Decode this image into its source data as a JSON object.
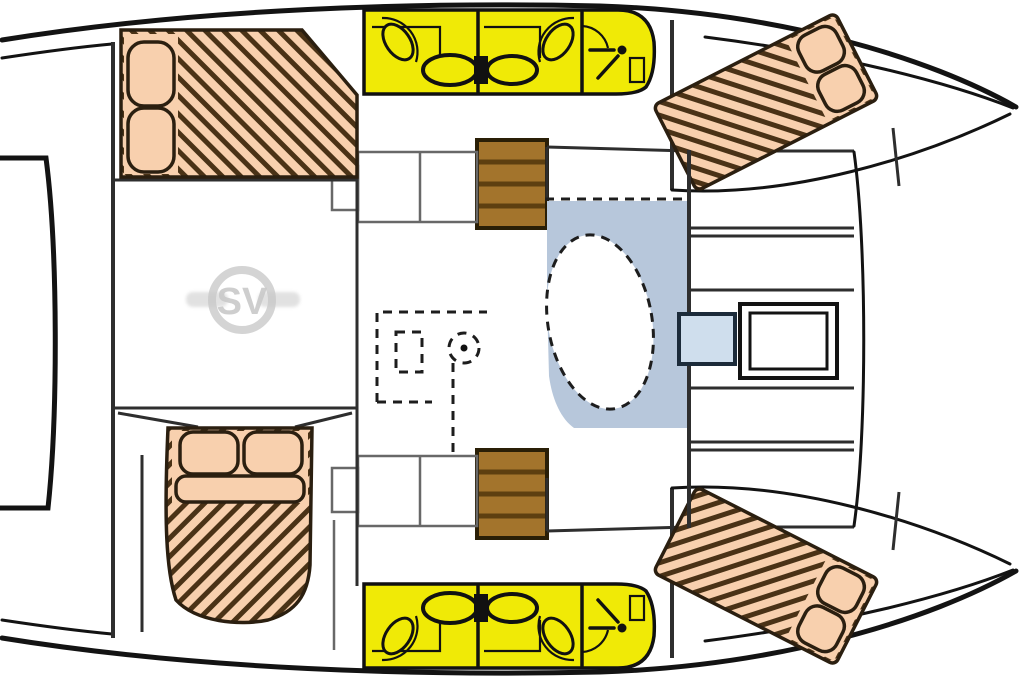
{
  "diagram": {
    "type": "catamaran-deck-plan",
    "watermark": {
      "monogram": "SV"
    }
  },
  "colors": {
    "background": "#ffffff",
    "hull_outline": "#131313",
    "interior_line": "#2e2e2e",
    "shelf_line": "#686868",
    "bed_fill": "#f8d0ae",
    "bed_hatch": "#4a3216",
    "bed_outline": "#2b1f10",
    "bathroom_yellow": "#f0ea06",
    "fixture_outline": "#111111",
    "wood_brown": "#a3742c",
    "wood_dark": "#5d3f10",
    "wood_border": "#2a1f07",
    "galley_blue": "#b7c7db",
    "hatch_fill": "#cfdeed",
    "hatch_border": "#1c2b3a",
    "dash_line": "#1d1d1d",
    "watermark": "#c9c9c9"
  },
  "icons": {
    "shower-head-icon": "diagonal spray line with nozzle dot",
    "toilet-icon": "oval bowl",
    "sink-icon": "corner oval basin with door arc",
    "companionway-steps-icon": "ladder treads"
  }
}
